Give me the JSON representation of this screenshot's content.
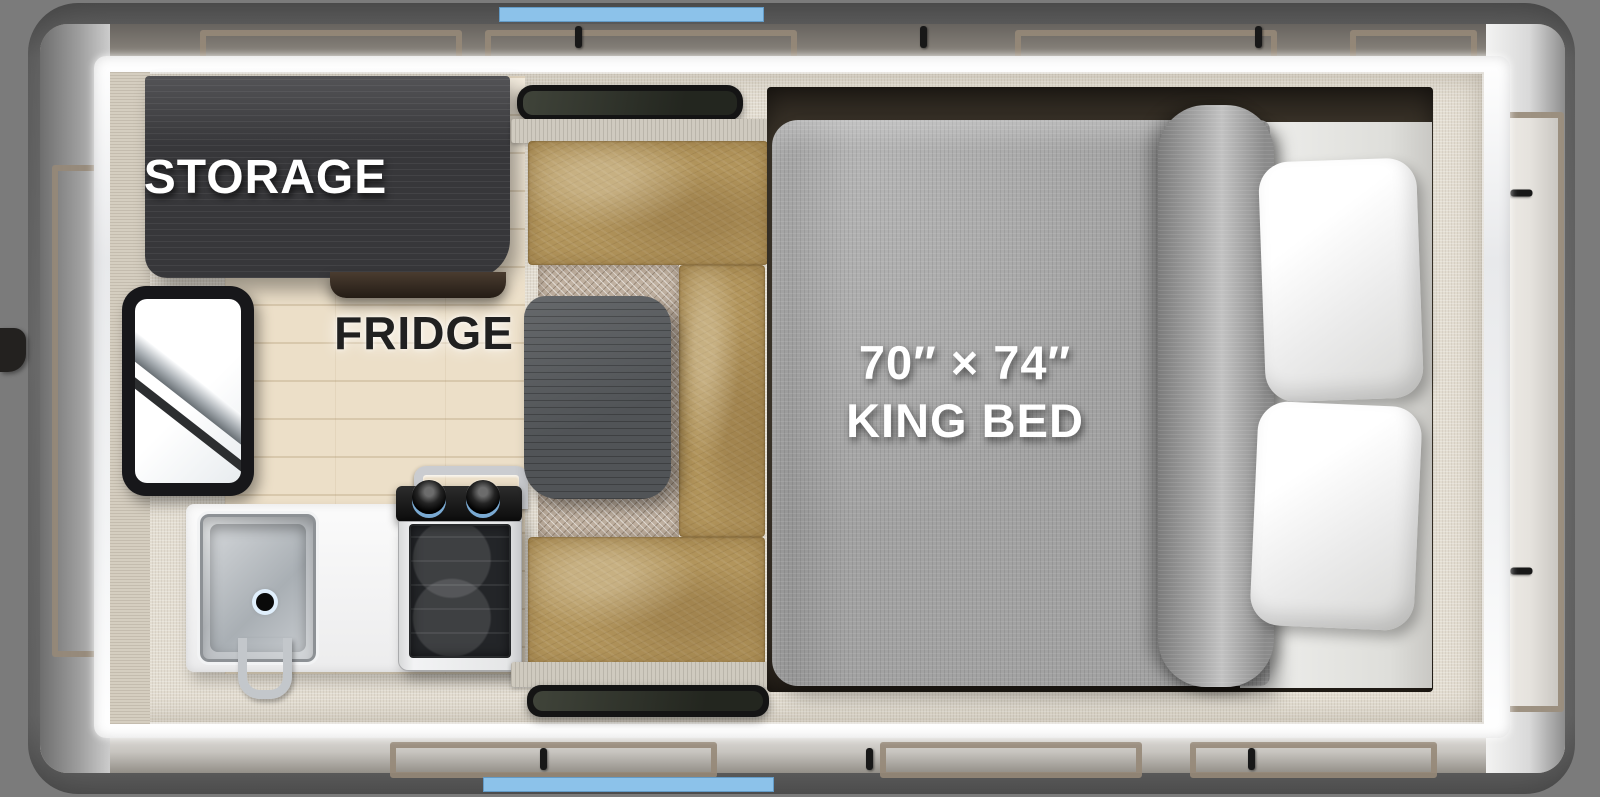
{
  "labels": {
    "storage": "STORAGE",
    "fridge": "FRIDGE",
    "bed_line1": "70″ × 74″",
    "bed_line2": "KING BED"
  },
  "colors": {
    "accent_blue": "#8CC2EA",
    "background_gray": "#7B7B7B",
    "exterior_trim_white": "#F3F4F5",
    "cabinet_charcoal": "#37373A",
    "bench_tan": "#B2955C",
    "table_slate": "#515457",
    "bed_comforter_gray": "#A2A2A2",
    "bed_platform_brown": "#453D31",
    "floor_beige": "#E3DDD1",
    "label_white": "#FFFFFF",
    "label_black": "#202020"
  }
}
